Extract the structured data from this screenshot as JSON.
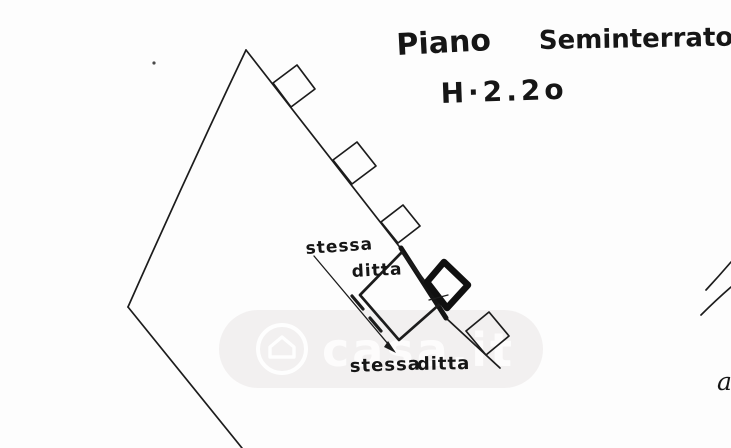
{
  "title": {
    "part1": "Piano",
    "part2": "Seminterrato",
    "height": "H·2.2o"
  },
  "annotations": {
    "upper_stessa": "stessa",
    "upper_ditta": "ditta",
    "lower_stessa": "stessa",
    "lower_ditta": "ditta",
    "edge_partial": "a"
  },
  "watermark": {
    "text": "casa.it",
    "icon": "house-in-circle-icon"
  },
  "colors": {
    "ink": "#1c1c1c",
    "paper": "#fdfdfd",
    "watermark_band": "#eae5e5",
    "watermark_glyphs": "#ffffff"
  }
}
